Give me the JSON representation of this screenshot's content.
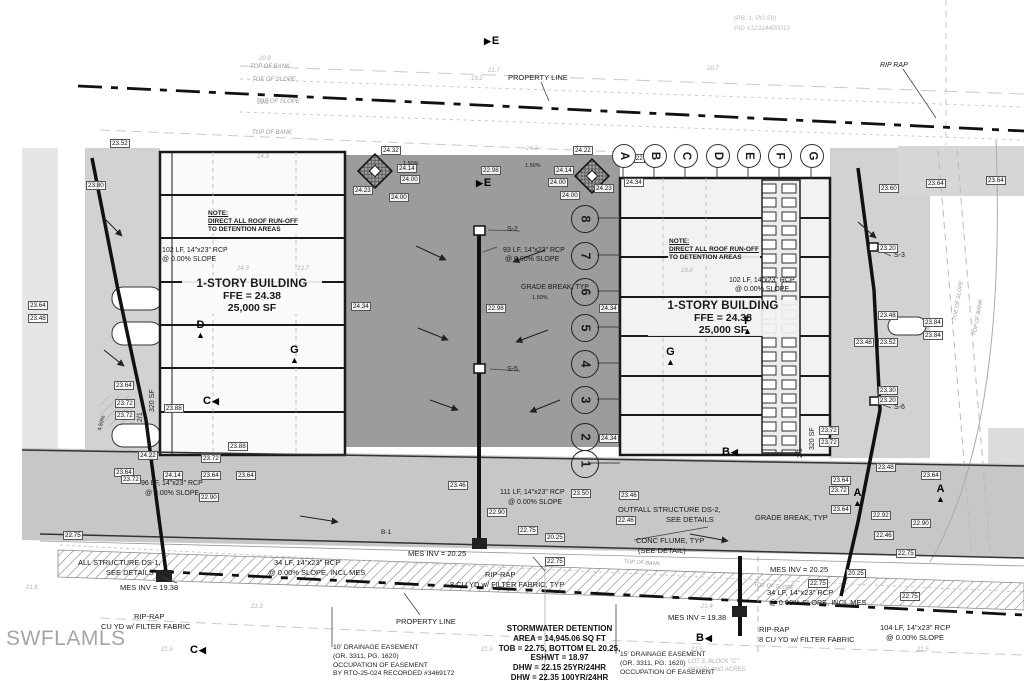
{
  "watermark": "SWFLAMLS",
  "colors": {
    "pavement": "#9c9c9c",
    "detention_strip": "#d2d2d2",
    "drive_band": "#c7c7c7",
    "linework": "#1a1a1a",
    "watermark_gray": "#a5a5a5"
  },
  "parcel": {
    "line1": "(PB. 1, PG 59)",
    "line2": "PID #12314400010"
  },
  "buildings": {
    "left": {
      "note1": "NOTE:",
      "note2": "DIRECT ALL ROOF RUN-OFF",
      "note3": "TO DETENTION AREAS",
      "title": "1-STORY BUILDING",
      "ffe": "FFE = 24.38",
      "area": "25,000 SF"
    },
    "right": {
      "note1": "NOTE:",
      "note2": "DIRECT ALL ROOF RUN-OFF",
      "note3": "TO DETENTION AREAS",
      "title": "1-STORY BUILDING",
      "ffe": "FFE = 24.38",
      "area": "25,000 SF"
    }
  },
  "stormwater": {
    "lines": [
      "STORMWATER DETENTION",
      "AREA = 14,945.06 SQ FT",
      "TOB = 22.75, BOTTOM EL 20.25,",
      "ESHWT = 18.97",
      "DHW = 22.15 25YR/24HR",
      "DHW = 22.35 100YR/24HR"
    ]
  },
  "easements": {
    "left": [
      "10' DRAINAGE EASEMENT",
      "(OR. 3311, PG. 1620)",
      "OCCUPATION OF EASEMENT",
      "BY RTO-25-024 RECORDED #3469172"
    ],
    "right": [
      "15' DRAINAGE EASEMENT",
      "(OR. 3311, PG. 1620)",
      "OCCUPATION OF EASEMENT"
    ]
  },
  "plat": {
    "line1": "LOT 3, BLOCK \"C\"",
    "line2": "WOODLAND ACRES"
  },
  "grid_y": 155,
  "grid_letters": [
    {
      "t": "A",
      "x": 623
    },
    {
      "t": "B",
      "x": 654
    },
    {
      "t": "C",
      "x": 685
    },
    {
      "t": "D",
      "x": 717
    },
    {
      "t": "E",
      "x": 748
    },
    {
      "t": "F",
      "x": 779
    },
    {
      "t": "G",
      "x": 811
    }
  ],
  "unit_x": 584,
  "unit_numbers": [
    {
      "t": "8",
      "y": 218
    },
    {
      "t": "7",
      "y": 255
    },
    {
      "t": "6",
      "y": 291
    },
    {
      "t": "5",
      "y": 327
    },
    {
      "t": "4",
      "y": 363
    },
    {
      "t": "3",
      "y": 399
    },
    {
      "t": "2",
      "y": 436
    },
    {
      "t": "1",
      "y": 463
    }
  ],
  "section_markers": [
    {
      "l": "E",
      "x": 484,
      "y": 36,
      "dir": "r"
    },
    {
      "l": "E",
      "x": 476,
      "y": 178,
      "dir": "r"
    },
    {
      "l": "D",
      "x": 196,
      "y": 320,
      "dir": "u"
    },
    {
      "l": "G",
      "x": 290,
      "y": 345,
      "dir": "u"
    },
    {
      "l": "C",
      "x": 203,
      "y": 396,
      "dir": "l"
    },
    {
      "l": "F",
      "x": 743,
      "y": 316,
      "dir": "u"
    },
    {
      "l": "G",
      "x": 666,
      "y": 347,
      "dir": "u"
    },
    {
      "l": "B",
      "x": 722,
      "y": 447,
      "dir": "l"
    },
    {
      "l": "A",
      "x": 853,
      "y": 488,
      "dir": "u"
    },
    {
      "l": "A",
      "x": 936,
      "y": 484,
      "dir": "u"
    },
    {
      "l": "B",
      "x": 696,
      "y": 633,
      "dir": "l"
    },
    {
      "l": "C",
      "x": 190,
      "y": 645,
      "dir": "l"
    }
  ],
  "annotations": [
    {
      "t": "PROPERTY LINE",
      "x": 508,
      "y": 74,
      "fs": 7.5
    },
    {
      "t": "RIP RAP",
      "x": 880,
      "y": 62,
      "i": 1
    },
    {
      "t": "TOP OF BANK",
      "x": 250,
      "y": 64,
      "fs": 6,
      "i": 1,
      "c": "#9a9a9a"
    },
    {
      "t": "TOE OF SLOPE",
      "x": 252,
      "y": 77,
      "fs": 6,
      "i": 1,
      "c": "#9a9a9a"
    },
    {
      "t": "TOE OF SLOPE",
      "x": 256,
      "y": 99,
      "fs": 6,
      "i": 1,
      "c": "#9a9a9a"
    },
    {
      "t": "TOP OF BANK",
      "x": 252,
      "y": 130,
      "fs": 6,
      "i": 1,
      "c": "#9a9a9a"
    },
    {
      "t": "102 LF, 14\"x23\" RCP",
      "x": 162,
      "y": 247
    },
    {
      "t": "@ 0.00% SLOPE",
      "x": 162,
      "y": 256
    },
    {
      "t": "S-2",
      "x": 507,
      "y": 226
    },
    {
      "t": "93 LF, 14\"x23\" RCP",
      "x": 503,
      "y": 247
    },
    {
      "t": "@ 0.00% SLOPE",
      "x": 505,
      "y": 256
    },
    {
      "t": "GRADE BREAK, TYP",
      "x": 521,
      "y": 284
    },
    {
      "t": "1.50%",
      "x": 532,
      "y": 295,
      "fs": 5.5
    },
    {
      "t": "S-5",
      "x": 507,
      "y": 366
    },
    {
      "t": "102 LF, 14\"x23\" RCP",
      "x": 729,
      "y": 277
    },
    {
      "t": "@ 0.00% SLOPE",
      "x": 735,
      "y": 286
    },
    {
      "t": "S-3",
      "x": 894,
      "y": 252
    },
    {
      "t": "S-6",
      "x": 894,
      "y": 404
    },
    {
      "t": "96 LF, 14\"x23\" RCP",
      "x": 141,
      "y": 480
    },
    {
      "t": "@ 0.00% SLOPE",
      "x": 145,
      "y": 490
    },
    {
      "t": "111 LF, 14\"x23\" RCP",
      "x": 500,
      "y": 489
    },
    {
      "t": "@ 0.00% SLOPE",
      "x": 508,
      "y": 499
    },
    {
      "t": "OUTFALL STRUCTURE DS-2,",
      "x": 618,
      "y": 506,
      "fs": 7.5
    },
    {
      "t": "SEE DETAILS",
      "x": 666,
      "y": 516,
      "fs": 7.5
    },
    {
      "t": "GRADE BREAK, TYP",
      "x": 755,
      "y": 514,
      "fs": 7.5
    },
    {
      "t": "CONC FLUME, TYP",
      "x": 636,
      "y": 537,
      "fs": 7.5
    },
    {
      "t": "(SEE DETAIL)",
      "x": 638,
      "y": 547,
      "fs": 7.5
    },
    {
      "t": "MES INV = 20.25",
      "x": 408,
      "y": 550,
      "fs": 7.5
    },
    {
      "t": "RIP-RAP",
      "x": 485,
      "y": 571,
      "fs": 7.5
    },
    {
      "t": "8 CU YD w/ FILTER FABRIC, TYP",
      "x": 450,
      "y": 581,
      "fs": 7.5
    },
    {
      "t": "PROPERTY LINE",
      "x": 396,
      "y": 618,
      "fs": 7.5
    },
    {
      "t": "ALL STRUCTURE DS-1,",
      "x": 78,
      "y": 559,
      "fs": 7.5
    },
    {
      "t": "SEE DETAILS",
      "x": 106,
      "y": 569,
      "fs": 7.5
    },
    {
      "t": "34 LF, 14\"x23\" RCP",
      "x": 274,
      "y": 559,
      "fs": 7.5
    },
    {
      "t": "@ 0.00% SLOPE, INCL MES",
      "x": 268,
      "y": 569,
      "fs": 7.5
    },
    {
      "t": "MES INV = 19.38",
      "x": 120,
      "y": 584,
      "fs": 7.5
    },
    {
      "t": "RIP-RAP",
      "x": 134,
      "y": 613,
      "fs": 7.5
    },
    {
      "t": "CU YD w/ FILTER FABRIC",
      "x": 101,
      "y": 623,
      "fs": 7.5
    },
    {
      "t": "MES INV = 19.38",
      "x": 668,
      "y": 614,
      "fs": 7.5
    },
    {
      "t": "MES INV = 20.25",
      "x": 770,
      "y": 566,
      "fs": 7.5
    },
    {
      "t": "34 LF, 14\"x23\" RCP",
      "x": 767,
      "y": 589,
      "fs": 7.5
    },
    {
      "t": "@ 0.00% SLOPE, INCL MES",
      "x": 769,
      "y": 599,
      "fs": 7.5
    },
    {
      "t": "RIP-RAP",
      "x": 759,
      "y": 626,
      "fs": 7.5
    },
    {
      "t": "8 CU YD w/ FILTER FABRIC",
      "x": 759,
      "y": 636,
      "fs": 7.5
    },
    {
      "t": "104 LF, 14\"x23\" RCP",
      "x": 880,
      "y": 624,
      "fs": 7.5
    },
    {
      "t": "@ 0.00% SLOPE",
      "x": 886,
      "y": 634,
      "fs": 7.5
    },
    {
      "t": "B-1",
      "x": 381,
      "y": 529,
      "fs": 6.5
    },
    {
      "t": "320 SF",
      "x": 149,
      "y": 412,
      "rot": -90
    },
    {
      "t": "2/1",
      "x": 137,
      "y": 422,
      "rot": -90
    },
    {
      "t": "320 SF",
      "x": 809,
      "y": 450,
      "rot": -90
    },
    {
      "t": "2/1",
      "x": 797,
      "y": 458,
      "rot": -90
    },
    {
      "t": "1.50%",
      "x": 403,
      "y": 161,
      "fs": 5.5
    },
    {
      "t": "1.50%",
      "x": 525,
      "y": 163,
      "fs": 5.5
    },
    {
      "t": "4.50%",
      "x": 97,
      "y": 430,
      "fs": 5.5,
      "rot": -75
    },
    {
      "t": "TOP OF BANK",
      "x": 624,
      "y": 559,
      "fs": 5.5,
      "i": 1,
      "c": "#9a9a9a",
      "rot": 4
    },
    {
      "t": "TOE OF SLOPE",
      "x": 754,
      "y": 582,
      "fs": 5.5,
      "i": 1,
      "c": "#9a9a9a",
      "rot": 5
    },
    {
      "t": "TOE OF SLOPE",
      "x": 952,
      "y": 320,
      "fs": 5.5,
      "i": 1,
      "c": "#9a9a9a",
      "rot": -80
    },
    {
      "t": "TOP OF BANK",
      "x": 972,
      "y": 335,
      "fs": 5.5,
      "i": 1,
      "c": "#9a9a9a",
      "rot": -80
    }
  ],
  "callouts": [
    {
      "t": "23.52",
      "x": 110,
      "y": 139
    },
    {
      "t": "23.80",
      "x": 86,
      "y": 181
    },
    {
      "t": "24.32",
      "x": 381,
      "y": 146
    },
    {
      "t": "24.14",
      "x": 397,
      "y": 164
    },
    {
      "t": "24.00",
      "x": 400,
      "y": 175
    },
    {
      "t": "24.23",
      "x": 353,
      "y": 186
    },
    {
      "t": "24.00",
      "x": 389,
      "y": 193
    },
    {
      "t": "22.98",
      "x": 481,
      "y": 166
    },
    {
      "t": "24.22",
      "x": 573,
      "y": 146
    },
    {
      "t": "24.14",
      "x": 554,
      "y": 166
    },
    {
      "t": "24.00",
      "x": 548,
      "y": 178
    },
    {
      "t": "24.23",
      "x": 594,
      "y": 184
    },
    {
      "t": "24.00",
      "x": 560,
      "y": 191
    },
    {
      "t": "24.22",
      "x": 625,
      "y": 154
    },
    {
      "t": "24.34",
      "x": 624,
      "y": 178
    },
    {
      "t": "24.34",
      "x": 351,
      "y": 302
    },
    {
      "t": "24.34",
      "x": 599,
      "y": 304
    },
    {
      "t": "24.34",
      "x": 599,
      "y": 434
    },
    {
      "t": "22.98",
      "x": 486,
      "y": 304
    },
    {
      "t": "23.64",
      "x": 114,
      "y": 381
    },
    {
      "t": "23.72",
      "x": 115,
      "y": 399
    },
    {
      "t": "23.72",
      "x": 115,
      "y": 411
    },
    {
      "t": "23.88",
      "x": 164,
      "y": 404
    },
    {
      "t": "23.88",
      "x": 228,
      "y": 442
    },
    {
      "t": "24.22",
      "x": 138,
      "y": 451
    },
    {
      "t": "23.72",
      "x": 201,
      "y": 454
    },
    {
      "t": "23.64",
      "x": 114,
      "y": 468
    },
    {
      "t": "24.14",
      "x": 163,
      "y": 471
    },
    {
      "t": "23.64",
      "x": 201,
      "y": 471
    },
    {
      "t": "23.64",
      "x": 236,
      "y": 471
    },
    {
      "t": "23.72",
      "x": 121,
      "y": 475
    },
    {
      "t": "22.90",
      "x": 199,
      "y": 493
    },
    {
      "t": "22.75",
      "x": 63,
      "y": 531
    },
    {
      "t": "23.64",
      "x": 28,
      "y": 301
    },
    {
      "t": "23.48",
      "x": 28,
      "y": 314
    },
    {
      "t": "23.46",
      "x": 448,
      "y": 481
    },
    {
      "t": "23.50",
      "x": 571,
      "y": 489
    },
    {
      "t": "23.46",
      "x": 619,
      "y": 491
    },
    {
      "t": "22.90",
      "x": 487,
      "y": 508
    },
    {
      "t": "22.75",
      "x": 518,
      "y": 526
    },
    {
      "t": "20.25",
      "x": 545,
      "y": 533
    },
    {
      "t": "22.75",
      "x": 545,
      "y": 557
    },
    {
      "t": "22.46",
      "x": 616,
      "y": 516
    },
    {
      "t": "23.60",
      "x": 879,
      "y": 184
    },
    {
      "t": "23.64",
      "x": 926,
      "y": 179
    },
    {
      "t": "23.64",
      "x": 986,
      "y": 176
    },
    {
      "t": "23.20",
      "x": 878,
      "y": 244
    },
    {
      "t": "23.48",
      "x": 878,
      "y": 311
    },
    {
      "t": "23.84",
      "x": 923,
      "y": 318
    },
    {
      "t": "23.84",
      "x": 923,
      "y": 331
    },
    {
      "t": "23.48",
      "x": 854,
      "y": 338
    },
    {
      "t": "23.52",
      "x": 878,
      "y": 338
    },
    {
      "t": "23.30",
      "x": 878,
      "y": 386
    },
    {
      "t": "23.20",
      "x": 878,
      "y": 396
    },
    {
      "t": "23.72",
      "x": 819,
      "y": 426
    },
    {
      "t": "23.72",
      "x": 819,
      "y": 438
    },
    {
      "t": "23.48",
      "x": 876,
      "y": 463
    },
    {
      "t": "23.64",
      "x": 921,
      "y": 471
    },
    {
      "t": "23.64",
      "x": 831,
      "y": 476
    },
    {
      "t": "23.72",
      "x": 829,
      "y": 486
    },
    {
      "t": "23.64",
      "x": 831,
      "y": 505
    },
    {
      "t": "22.92",
      "x": 871,
      "y": 511
    },
    {
      "t": "22.90",
      "x": 911,
      "y": 519
    },
    {
      "t": "22.46",
      "x": 874,
      "y": 531
    },
    {
      "t": "22.75",
      "x": 896,
      "y": 549
    },
    {
      "t": "22.75",
      "x": 808,
      "y": 579
    },
    {
      "t": "20.25",
      "x": 846,
      "y": 569
    },
    {
      "t": "22.75",
      "x": 900,
      "y": 592
    },
    {
      "t": "20.8",
      "x": 258,
      "y": 56,
      "p": 1
    },
    {
      "t": "21.7",
      "x": 487,
      "y": 68,
      "p": 1
    },
    {
      "t": "20.7",
      "x": 706,
      "y": 66,
      "p": 1
    },
    {
      "t": "19.2",
      "x": 470,
      "y": 76,
      "p": 1
    },
    {
      "t": "18.3",
      "x": 256,
      "y": 100,
      "p": 1
    },
    {
      "t": "24.3",
      "x": 256,
      "y": 154,
      "p": 1
    },
    {
      "t": "24.3",
      "x": 525,
      "y": 146,
      "p": 1
    },
    {
      "t": "24.3",
      "x": 236,
      "y": 266,
      "p": 1
    },
    {
      "t": "23.7",
      "x": 296,
      "y": 266,
      "p": 1
    },
    {
      "t": "23.8",
      "x": 680,
      "y": 268,
      "p": 1
    },
    {
      "t": "21.8",
      "x": 25,
      "y": 585,
      "p": 1
    },
    {
      "t": "21.3",
      "x": 250,
      "y": 604,
      "p": 1
    },
    {
      "t": "21.4",
      "x": 700,
      "y": 604,
      "p": 1
    },
    {
      "t": "21.5",
      "x": 160,
      "y": 647,
      "p": 1
    },
    {
      "t": "21.5",
      "x": 480,
      "y": 647,
      "p": 1
    },
    {
      "t": "21.5",
      "x": 690,
      "y": 647,
      "p": 1
    },
    {
      "t": "21.5",
      "x": 916,
      "y": 647,
      "p": 1
    }
  ]
}
